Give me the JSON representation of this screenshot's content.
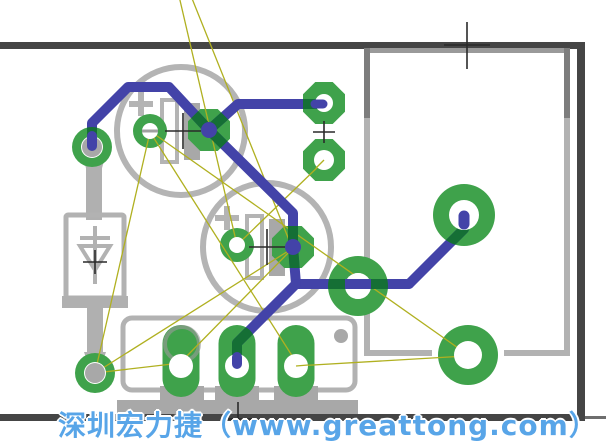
{
  "watermark": {
    "text": "深圳宏力捷（www.greattong.com）",
    "color": "#58a5e8"
  },
  "editor": {
    "background_color": "#ffffff",
    "board_outline_color": "#454545",
    "trace_color": "#4343a8",
    "pad_color": "#3fa24b",
    "pad_trace_overlap_color": "#156f35",
    "silkscreen_color": "#b4b4b4",
    "silkscreen_dark_color": "#a6a6a6",
    "ratsnest_color": "#b0b020",
    "origin_cross_color": "#2a2a2a",
    "drill_hole_color": "#ffffff",
    "lead_color": "#a8a8a8"
  },
  "components": [
    {
      "name": "electrolytic-capacitor-1"
    },
    {
      "name": "electrolytic-capacitor-2"
    },
    {
      "name": "diode"
    },
    {
      "name": "terminal-block-3pin"
    },
    {
      "name": "relay-outline"
    }
  ]
}
